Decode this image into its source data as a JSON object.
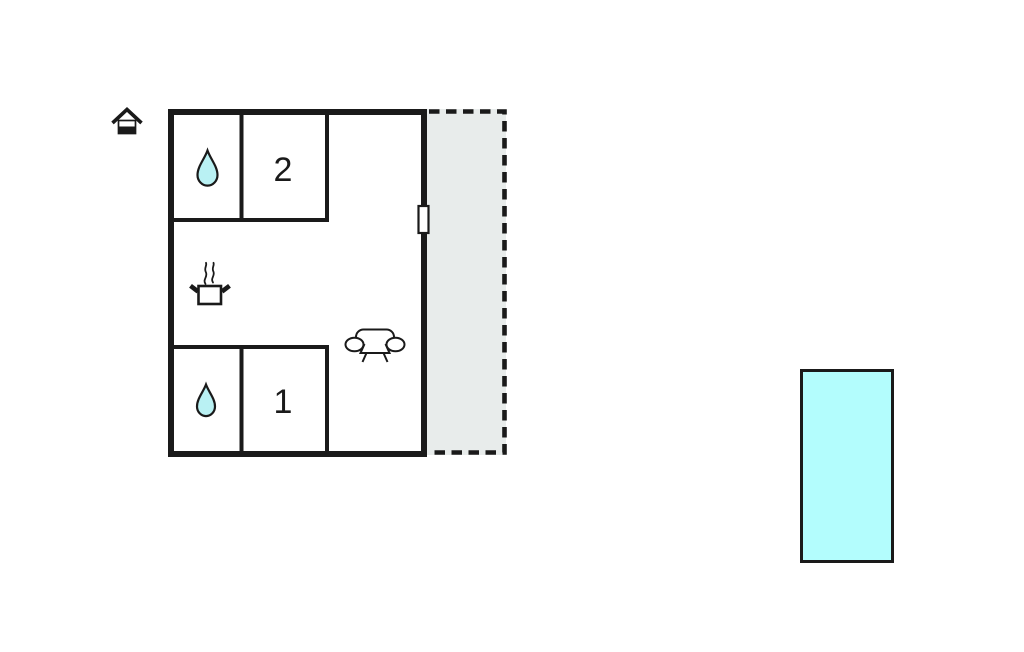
{
  "plan": {
    "kind": "holiday-home-floor-plan",
    "room1_label": "1",
    "room2_label": "2"
  },
  "icons": {
    "entrance": "house-icon",
    "bathroom_upper": "water-drop-icon",
    "bathroom_lower": "water-drop-icon",
    "kitchen": "cooking-pot-icon",
    "living_area": "sofa-icon",
    "door": "door-marker"
  },
  "areas": {
    "terrace": {
      "fill": "#e8eceb",
      "border_style": "dashed"
    },
    "pool": {
      "fill": "#b3fdfd"
    }
  },
  "colors": {
    "wall": "#1a1a1a",
    "background": "#ffffff",
    "water_drop": "#b9f1f3"
  }
}
